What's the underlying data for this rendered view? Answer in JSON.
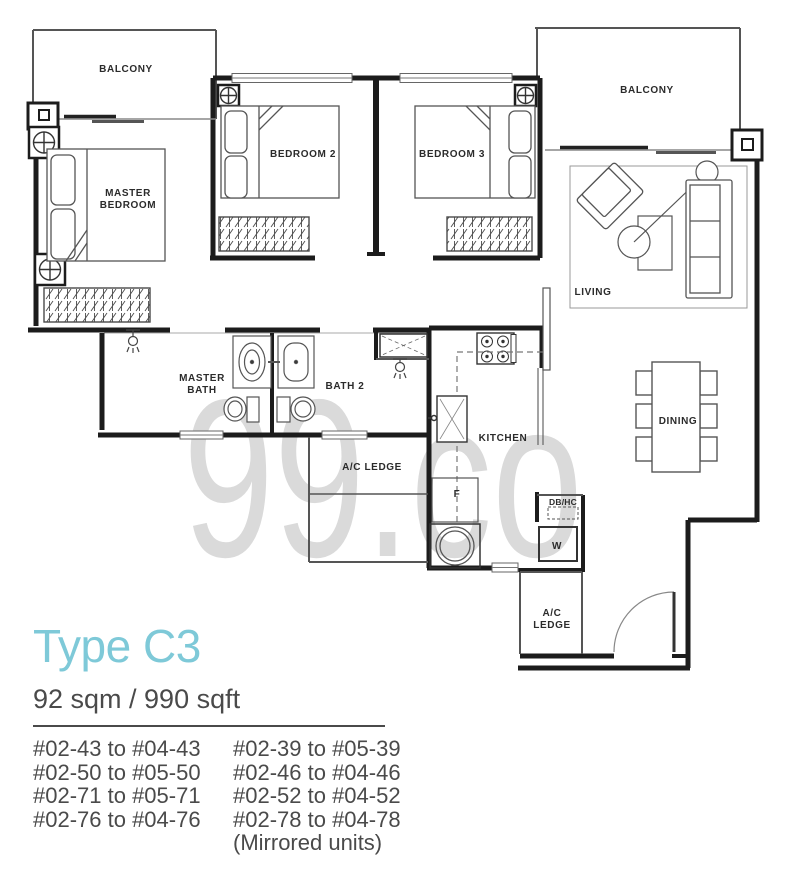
{
  "title": "Type C3",
  "area": "92 sqm / 990 sqft",
  "watermark": "99.co",
  "units": {
    "col1": [
      "#02-43 to #04-43",
      "#02-50 to #05-50",
      "#02-71 to #05-71",
      "#02-76 to #04-76"
    ],
    "col2": [
      "#02-39 to #05-39",
      "#02-46 to #04-46",
      "#02-52 to #04-52",
      "#02-78 to #04-78"
    ],
    "note": "(Mirrored units)"
  },
  "colors": {
    "accent": "#7ec9d8",
    "body_text": "#4a4a4a",
    "watermark": "#dadada",
    "wall": "#1c1c1c"
  },
  "plan": {
    "labels": {
      "balcony_left": "BALCONY",
      "balcony_right": "BALCONY",
      "master_bedroom_l1": "MASTER",
      "master_bedroom_l2": "BEDROOM",
      "bedroom2": "BEDROOM 2",
      "bedroom3": "BEDROOM 3",
      "living": "LIVING",
      "master_bath_l1": "MASTER",
      "master_bath_l2": "BATH",
      "bath2": "BATH 2",
      "ac_ledge_mid": "A/C LEDGE",
      "kitchen": "KITCHEN",
      "dining": "DINING",
      "fridge": "F",
      "db_hc": "DB/HC",
      "washer": "W",
      "ac_ledge_bot_l1": "A/C",
      "ac_ledge_bot_l2": "LEDGE"
    }
  }
}
